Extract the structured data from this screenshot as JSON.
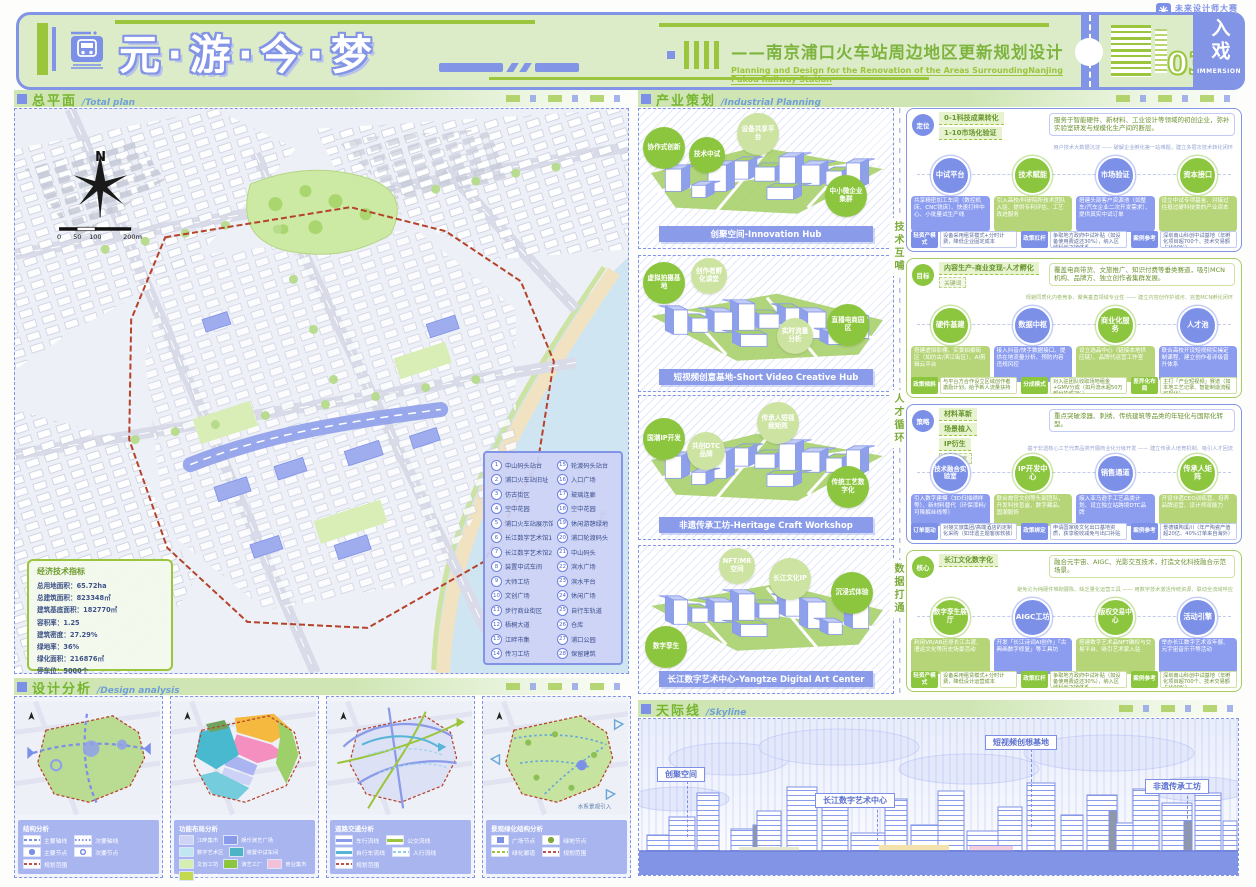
{
  "brand": {
    "name": "未来设计师大赛"
  },
  "header": {
    "title": "元·游·今·梦",
    "subtitle_cn": "——南京浦口火车站周边地区更新规划设计",
    "subtitle_en": "Planning and Design for the Renovation of the Areas SurroundingNanjing Pukou Railway Station",
    "sheet_no": "03",
    "badge_cn": "入戏",
    "badge_en": "IMMERSION"
  },
  "sections": {
    "total_plan": {
      "cn": "总平面",
      "en": "/Total plan"
    },
    "design_analysis": {
      "cn": "设计分析",
      "en": "/Design analysis"
    },
    "industry": {
      "cn": "产业策划",
      "en": "/Industrial Planning"
    },
    "skyline": {
      "cn": "天际线",
      "en": "/Skyline"
    }
  },
  "total_plan": {
    "compass": "N",
    "scale_labels": [
      "0",
      "50",
      "100",
      "200m"
    ],
    "river_label": "长江",
    "indicators": {
      "title": "经济技术指标",
      "rows": [
        {
          "label": "总用地面积：",
          "value": "65.72ha"
        },
        {
          "label": "总建筑面积：",
          "value": "823348㎡"
        },
        {
          "label": "建筑基底面积：",
          "value": "182770㎡"
        },
        {
          "label": "容积率：",
          "value": "1.25"
        },
        {
          "label": "建筑密度：",
          "value": "27.29%"
        },
        {
          "label": "绿地率：",
          "value": "36%"
        },
        {
          "label": "绿化面积：",
          "value": "216876㎡"
        },
        {
          "label": "停车位：",
          "value": "5000个"
        }
      ]
    },
    "legend": {
      "items": [
        {
          "num": "1",
          "label": "中山码头站台"
        },
        {
          "num": "2",
          "label": "浦口火车站旧址"
        },
        {
          "num": "3",
          "label": "仿古街区"
        },
        {
          "num": "4",
          "label": "空中花园"
        },
        {
          "num": "5",
          "label": "浦口火车站展示馆"
        },
        {
          "num": "6",
          "label": "长江数字艺术馆1"
        },
        {
          "num": "7",
          "label": "长江数字艺术馆2"
        },
        {
          "num": "8",
          "label": "装置中试车间"
        },
        {
          "num": "9",
          "label": "大师工坊"
        },
        {
          "num": "10",
          "label": "文创广场"
        },
        {
          "num": "11",
          "label": "步行商业街区"
        },
        {
          "num": "12",
          "label": "梧桐大道"
        },
        {
          "num": "13",
          "label": "江畔市集"
        },
        {
          "num": "14",
          "label": "传习工坊"
        },
        {
          "num": "15",
          "label": "轮渡码头站台"
        },
        {
          "num": "16",
          "label": "入口广场"
        },
        {
          "num": "17",
          "label": "玻璃连廊"
        },
        {
          "num": "18",
          "label": "空中花园"
        },
        {
          "num": "19",
          "label": "休闲游憩绿地"
        },
        {
          "num": "20",
          "label": "浦口轮渡码头"
        },
        {
          "num": "21",
          "label": "中山码头"
        },
        {
          "num": "22",
          "label": "滨水广场"
        },
        {
          "num": "23",
          "label": "滨水平台"
        },
        {
          "num": "24",
          "label": "休闲广场"
        },
        {
          "num": "25",
          "label": "自行车轨道"
        },
        {
          "num": "26",
          "label": "仓库"
        },
        {
          "num": "27",
          "label": "浦口公园"
        },
        {
          "num": "28",
          "label": "保留建筑"
        }
      ]
    }
  },
  "design_analysis": {
    "panels": [
      {
        "legend_title": "结构分析",
        "items": [
          {
            "sw": "line-dash-blue",
            "label": "主要轴线"
          },
          {
            "sw": "line-dot-blue",
            "label": "次要轴线"
          },
          {
            "sw": "node-main",
            "label": "主要节点"
          },
          {
            "sw": "node-sub",
            "label": "次要节点"
          },
          {
            "sw": "line-dash-red",
            "label": "规划范围"
          }
        ]
      },
      {
        "legend_title": "功能布局分析",
        "items": [
          {
            "sw": "fill-lavender",
            "label": "江畔集市"
          },
          {
            "sw": "fill-blue",
            "label": "娱乐演艺广场"
          },
          {
            "sw": "fill-cyan",
            "label": "数字艺术区"
          },
          {
            "sw": "fill-teal",
            "label": "装置中试车间"
          },
          {
            "sw": "fill-lightgreen",
            "label": "文创工坊"
          },
          {
            "sw": "fill-green",
            "label": "演艺工厂"
          },
          {
            "sw": "fill-pink",
            "label": "商业集市"
          },
          {
            "sw": "fill-yellowgreen",
            "label": "传习工坊"
          }
        ]
      },
      {
        "legend_title": "道路交通分析",
        "items": [
          {
            "sw": "line-solid-purple",
            "label": "车行流线"
          },
          {
            "sw": "line-solid-green",
            "label": "公交流线"
          },
          {
            "sw": "line-solid-cyan",
            "label": "自行车流线"
          },
          {
            "sw": "line-dash-cyan",
            "label": "人行流线"
          },
          {
            "sw": "line-dash-red",
            "label": "规划范围"
          }
        ]
      },
      {
        "legend_title": "景观绿化结构分析",
        "note": "水系景观引入",
        "items": [
          {
            "sw": "node-plaza",
            "label": "广场节点"
          },
          {
            "sw": "node-green",
            "label": "绿地节点"
          },
          {
            "sw": "line-arrow-green",
            "label": "绿化廊道"
          },
          {
            "sw": "line-dash-red",
            "label": "规划范围"
          }
        ]
      }
    ]
  },
  "industry": {
    "spine": [
      "技术互哺",
      "人才循环",
      "数据打通"
    ],
    "diagrams": [
      {
        "label": "创聚空间-Innovation Hub",
        "bubbles": [
          "协作式创新",
          "技术中试",
          "设备共享平台",
          "中小微企业集群"
        ]
      },
      {
        "label": "短视频创意基地-Short Video Creative Hub",
        "bubbles": [
          "虚拟拍摄基地",
          "创作者孵化课堂",
          "直播电商园区",
          "实时流量分析"
        ]
      },
      {
        "label": "非遗传承工坊-Heritage Craft Workshop",
        "bubbles": [
          "国潮IP开发",
          "共创DTC品牌",
          "传承人短视频矩阵",
          "传统工艺数字化"
        ]
      },
      {
        "label": "长江数字艺术中心-Yangtze Digital Art Center",
        "bubbles": [
          "NFT/MR空间",
          "长江文化IP",
          "沉浸式体验",
          "数字孪生"
        ]
      }
    ],
    "blocks": [
      {
        "tag": "定位",
        "heads": [
          "0-1科技成果转化",
          "1-10市场化验证"
        ],
        "desc": "服务于智能硬件、新材料、工业设计等领域的初创企业，弥补实验室研发与规模化生产间的断层。",
        "note": "用户技术大数据沉淀 —— 破解企业孵化第一站难题，建立多层次技术转化闭环",
        "circles": [
          {
            "label": "中试平台",
            "card": "共享精密加工车间（数控机床、CNC铣床）、快速打样中心、小批量试生产线"
          },
          {
            "label": "技术赋能",
            "card": "引入高校/科研院所技术团队入驻、提供专利评估、工艺改进服务"
          },
          {
            "label": "市场验证",
            "card": "搭建头部客户资源池（如整车/汽车企业二次开发需求）、提供真实中试订单"
          },
          {
            "label": "资本接口",
            "card": "设立中试专项基金、对接过往投过硬科技类的产业资本"
          }
        ],
        "footer": [
          {
            "tag": "轻资产模式",
            "text": "设备采用租赁模式+分时计费，降低企业固定成本"
          },
          {
            "tag": "政策杠杆",
            "text": "争取地方政府中试补贴（如设备使用费返还30%），纳入区域科创飞地体系"
          },
          {
            "tag": "案例参考",
            "text": "深圳南山科创中试基地（年孵化项目超700个、技术交易额占比90%）"
          }
        ]
      },
      {
        "tag": "目标",
        "heads": [
          "内容生产-商业变现-人才孵化"
        ],
        "keyword": "关键词",
        "desc": "覆盖电商带货、文旅推广、知识付费等垂类赛道，吸引MCN机构、品牌方、独立创作者集群发展。",
        "note": "规避同质化内卷竞争、聚焦垂直领域专业性 —— 建立内容创作护城河、完善MCN孵化闭环",
        "circles": [
          {
            "label": "硬件基建",
            "card": "搭建虚拟影棚、实景拍摄街区（如仿古/滨江街区）、AI剪辑云平台"
          },
          {
            "label": "数据中枢",
            "card": "接入抖音/快手数据接口、提供在地流量分析、预防内容违规风控"
          },
          {
            "label": "商业化服务",
            "card": "设立选品中心（链接本地供应链）、品牌代运营工作室"
          },
          {
            "label": "人才池",
            "card": "联合高校开设短视频实操定制课程、建立创作者评级晋升体系"
          }
        ],
        "footer": [
          {
            "tag": "政策倾斜",
            "text": "与平台方合作设立区域创作者激励计划，给予新人流量扶持"
          },
          {
            "tag": "分成模式",
            "text": "对入驻团队收取场地租金+GMV分成（如月流水超50万部分抽成2%）"
          },
          {
            "tag": "差异化布局",
            "text": "主打「产业短视频」赛道（如本地工艺记录、智能制造流程可视化）"
          }
        ]
      },
      {
        "tag": "策略",
        "heads": [
          "材料革新",
          "场景植入",
          "IP衍生"
        ],
        "extra": "渠道拓宽",
        "desc": "重点突破漆器、刺绣、传统建筑等品类的年轻化与国际化转型。",
        "note": "基于非遗核心工艺代表品类开展商业化分级开发 —— 建立传承人培育机制、吸引人才回流",
        "circles": [
          {
            "label": "技术融合实验室",
            "card": "引入数字建模（3D扫描绣样等）、新材料替代（环保漆料/可降解丝线等）"
          },
          {
            "label": "IP开发中心",
            "card": "联合故宫文创等头部团队，开发科技盲盒、数字藏品、国潮服饰"
          },
          {
            "label": "销售通道",
            "card": "接入亚马逊手工艺品类计划、设立独立站跨境DTC品牌"
          },
          {
            "label": "传承人矩阵",
            "card": "开设非遗CEO训练营、培养品牌运营、设计师双能力"
          }
        ],
        "footer": [
          {
            "tag": "订单驱动",
            "text": "对接文旅集团/高端酒店的定制化采购（如非遗主题客房软装）"
          },
          {
            "tag": "政策绑定",
            "text": "申请国家级文化出口基地资质，获享税收减免与出口补贴"
          },
          {
            "tag": "案例参考",
            "text": "景德镇陶溪川（年产陶瓷产值超20亿、40%订单来自海外）"
          }
        ]
      },
      {
        "tag": "核心",
        "heads": [
          "长江文化数字化"
        ],
        "desc": "融合元宇宙、AIGC、光影交互技术，打造文化科技融合示范场景。",
        "note": "避免沦为纯硬件堆砌展陈、缺乏量化运营工具 —— 用数字技术激活传统资源、联动全流域呼应",
        "circles": [
          {
            "label": "数字孪生展厅",
            "card": "利用VR/AR还原长江古渡、漕运文化等历史场景活动"
          },
          {
            "label": "AIGC工坊",
            "card": "开发「长江诗词AI创作」「古典画数字修复」等工具坊"
          },
          {
            "label": "版权交易中心",
            "card": "搭建数字艺术品NFT确权与交易平台、吸引艺术家入驻"
          },
          {
            "label": "活动引擎",
            "card": "举办长江数字艺术双年展、元宇宙音乐节等活动"
          }
        ],
        "footer": [
          {
            "tag": "轻资产模式",
            "text": "设备采用租赁模式+分时计费，降低设计运营成本"
          },
          {
            "tag": "政策杠杆",
            "text": "争取地方政府中试补贴（如设备使用费返还30%），纳入区域科创飞地体系"
          },
          {
            "tag": "案例参考",
            "text": "深圳南山科创中试基地（年孵化项目超700个、技术交易额占比90%）"
          }
        ]
      }
    ]
  },
  "skyline": {
    "labels": [
      "创聚空间",
      "短视频创想基地",
      "长江数字艺术中心",
      "非遗传承工坊"
    ]
  }
}
